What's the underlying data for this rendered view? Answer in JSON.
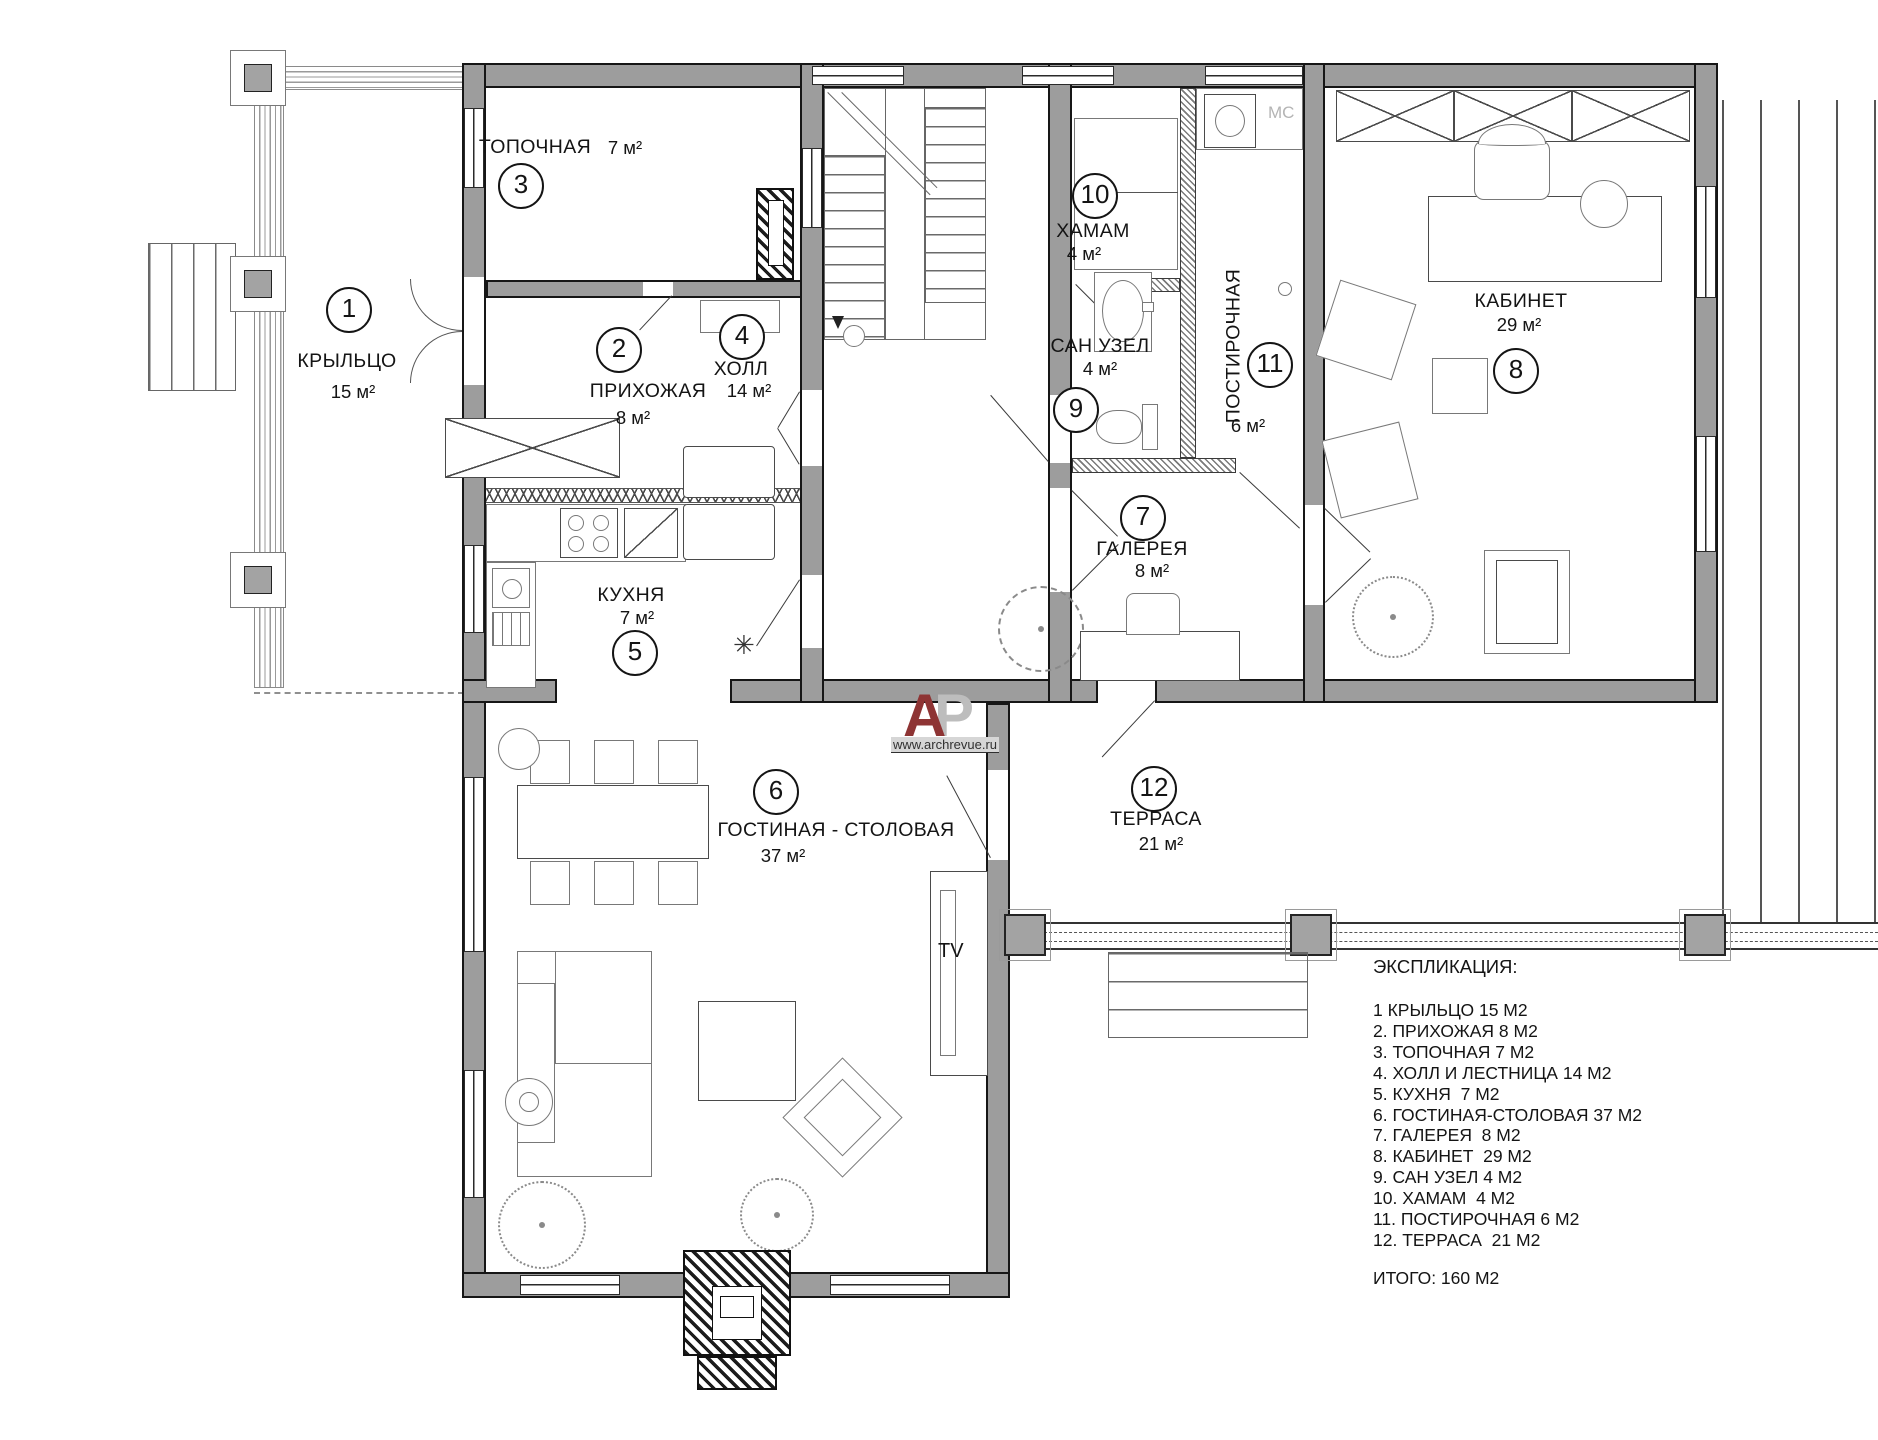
{
  "rooms": {
    "porch": {
      "num": "1",
      "name": "КРЫЛЬЦО",
      "area": "15 м²"
    },
    "hallway": {
      "num": "2",
      "name": "ПРИХОЖАЯ",
      "area": "8 м²"
    },
    "boiler": {
      "num": "3",
      "name": "ТОПОЧНАЯ",
      "area": "7 м²"
    },
    "hall": {
      "num": "4",
      "name": "ХОЛЛ",
      "area": "14 м²"
    },
    "kitchen": {
      "num": "5",
      "name": "КУХНЯ",
      "area": "7 м²"
    },
    "living": {
      "num": "6",
      "name": "ГОСТИНАЯ - СТОЛОВАЯ",
      "area": "37 м²"
    },
    "gallery": {
      "num": "7",
      "name": "ГАЛЕРЕЯ",
      "area": "8 м²"
    },
    "office": {
      "num": "8",
      "name": "КАБИНЕТ",
      "area": "29 м²"
    },
    "wc": {
      "num": "9",
      "name": "САН УЗЕЛ",
      "area": "4 м²"
    },
    "hammam": {
      "num": "10",
      "name": "ХАМАМ",
      "area": "4 м²"
    },
    "laundry": {
      "num": "11",
      "name": "ПОСТИРОЧНАЯ",
      "area": "6 м²"
    },
    "terrace": {
      "num": "12",
      "name": "ТЕРРАСА",
      "area": "21 м²"
    }
  },
  "labels": {
    "tv": "TV",
    "mc": "МС",
    "kitchen_symbol": "✳"
  },
  "legend": {
    "title": "ЭКСПЛИКАЦИЯ:",
    "items": [
      "1 КРЫЛЬЦО 15 М2",
      "2. ПРИХОЖАЯ 8 М2",
      "3. ТОПОЧНАЯ 7 М2",
      "4. ХОЛЛ И ЛЕСТНИЦА 14 М2",
      "5. КУХНЯ  7 М2",
      "6. ГОСТИНАЯ-СТОЛОВАЯ 37 М2",
      "7. ГАЛЕРЕЯ  8 М2",
      "8. КАБИНЕТ  29 М2",
      "9. САН УЗЕЛ 4 М2",
      "10. ХАМАМ  4 М2",
      "11. ПОСТИРОЧНАЯ 6 М2",
      "12. ТЕРРАСА  21 М2"
    ],
    "total": "ИТОГО: 160 М2"
  },
  "logo": {
    "letter_a": "А",
    "letter_r": "Р",
    "url": "www.archrevue.ru"
  },
  "colors": {
    "wall": "#9d9d9d",
    "logo_red": "#8e3434",
    "logo_gray": "#bdbdbd",
    "mc_gray": "#b4b4b4"
  }
}
